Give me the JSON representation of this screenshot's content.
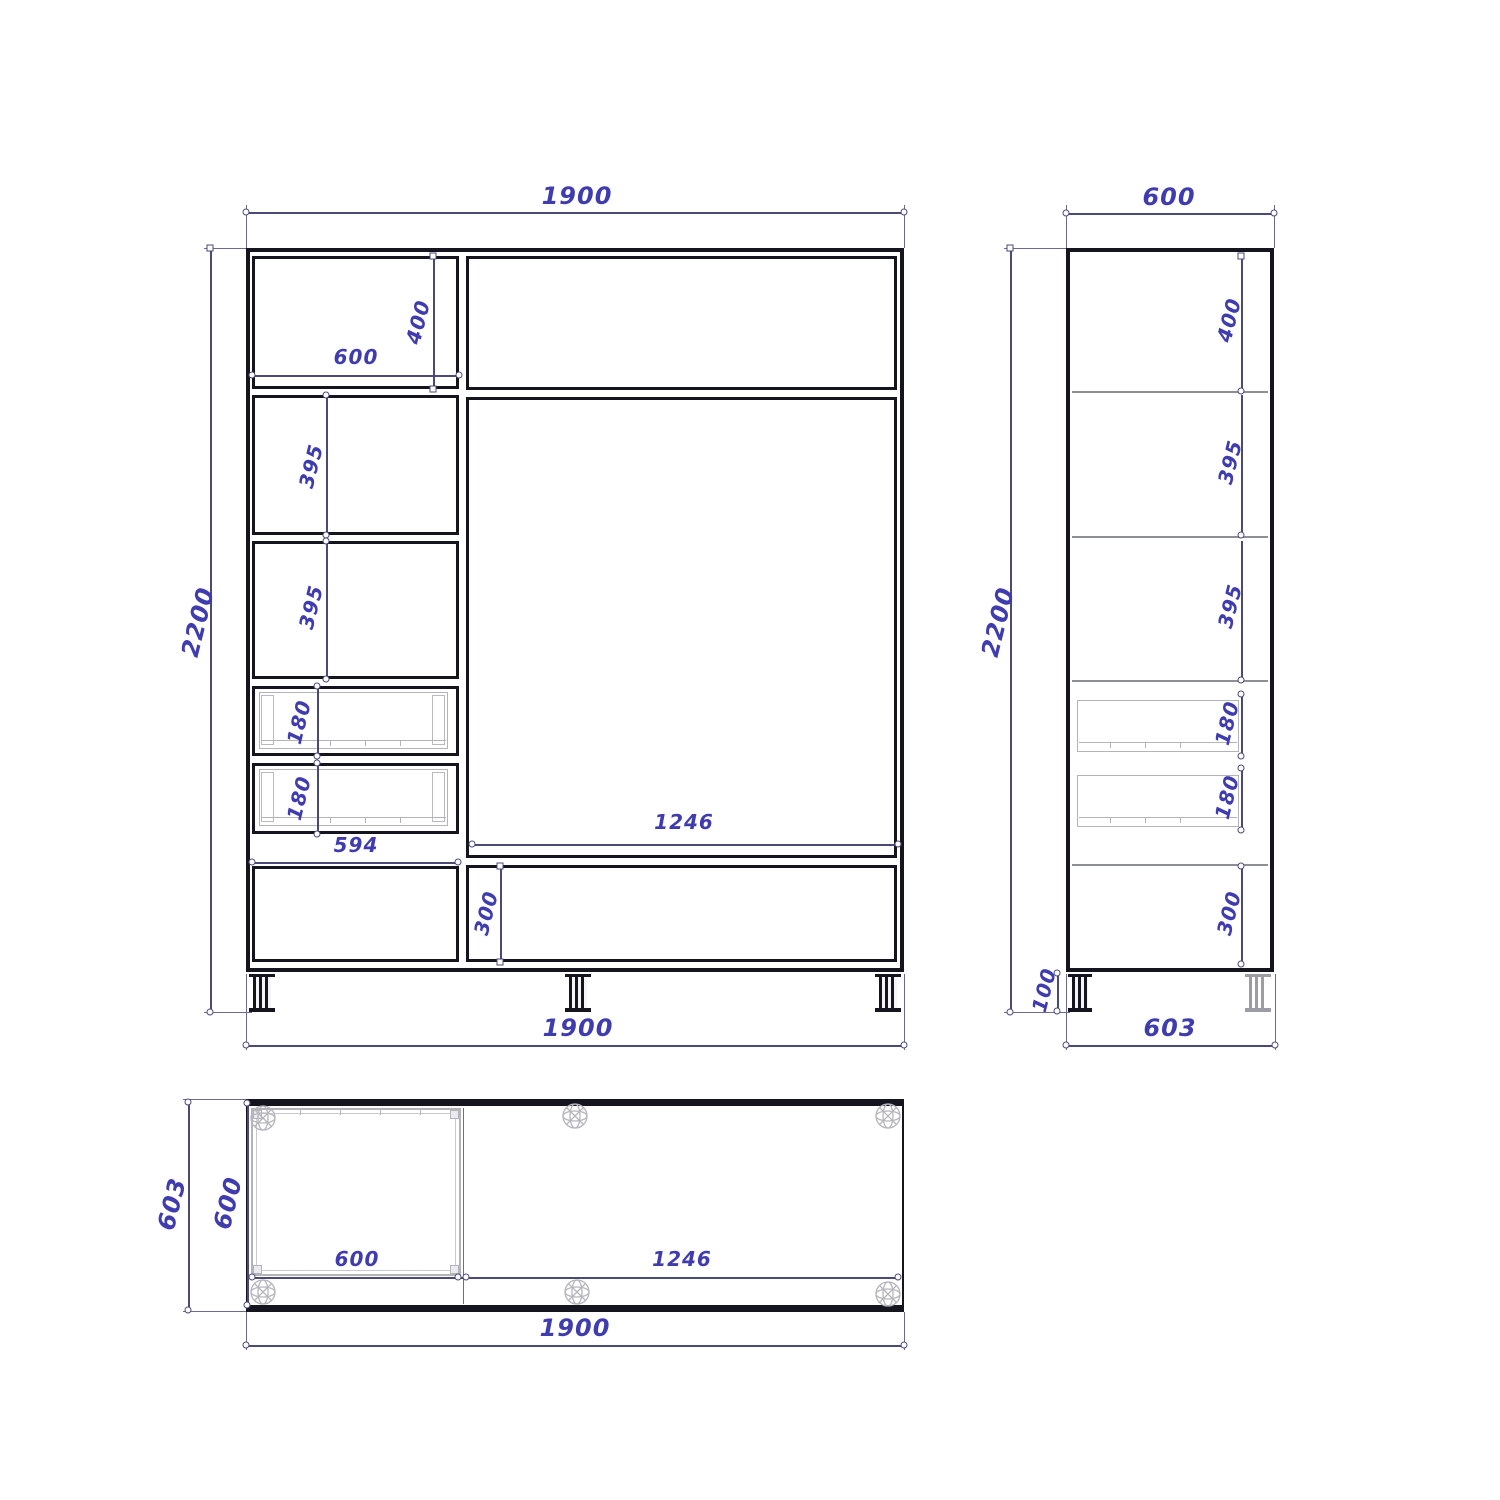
{
  "drawing": {
    "kind": "cabinet blueprint, three orthographic views",
    "views": {
      "front": "front view",
      "side": "side view",
      "plan": "top view"
    }
  },
  "colors": {
    "background": "#ffffff",
    "geometry_line": "#15151f",
    "dimension_line": "#4a4a78",
    "dimension_text": "#3f3cb0",
    "light_detail": "#b3b3ba"
  },
  "dims": {
    "front_width_top": "1900",
    "front_height": "2200",
    "front_top_cell_width": "600",
    "front_top_cell_height": "400",
    "front_shelf_1": "395",
    "front_shelf_2": "395",
    "front_drawer_1": "180",
    "front_drawer_2": "180",
    "front_drawer_width": "594",
    "front_right_section_width": "1246",
    "front_bottom_drawer_height": "300",
    "front_width_bottom": "1900",
    "side_width_top": "600",
    "side_height": "2200",
    "side_top_cell_height": "400",
    "side_shelf_1": "395",
    "side_shelf_2": "395",
    "side_drawer_1": "180",
    "side_drawer_2": "180",
    "side_bottom_drawer_height": "300",
    "side_leg_height": "100",
    "side_depth_bottom": "603",
    "plan_depth_outer": "603",
    "plan_depth_inner": "600",
    "plan_module_width": "600",
    "plan_right_section_width": "1246",
    "plan_width_bottom": "1900"
  }
}
